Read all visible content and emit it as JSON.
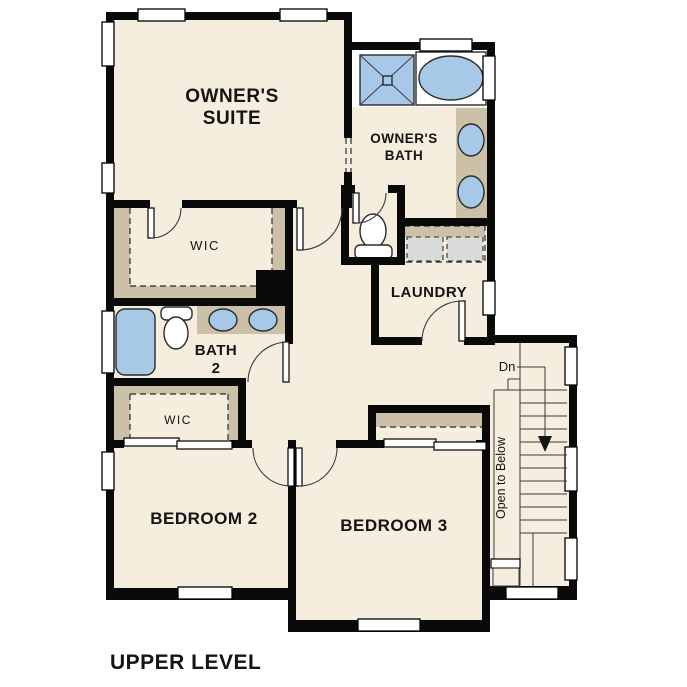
{
  "floor_label": "UPPER LEVEL",
  "rooms": {
    "owners_suite": {
      "line1": "OWNER'S",
      "line2": "SUITE"
    },
    "owners_bath": {
      "line1": "OWNER'S",
      "line2": "BATH"
    },
    "owners_wic": {
      "label": "WIC"
    },
    "bath2": {
      "line1": "BATH",
      "line2": "2"
    },
    "laundry": {
      "label": "LAUNDRY"
    },
    "bedroom2_wic": {
      "label": "WIC"
    },
    "bedroom2": {
      "label": "BEDROOM 2"
    },
    "bedroom3": {
      "label": "BEDROOM 3"
    }
  },
  "stairs": {
    "direction_label": "Dn",
    "open_to_below_label": "Open to Below"
  },
  "fixtures": [
    "shower",
    "soaking-tub",
    "double-vanity",
    "toilet",
    "washer-dryer",
    "bathtub",
    "toilet",
    "double-vanity"
  ],
  "palette": {
    "wall": "#0a0a0a",
    "floor": "#f5eddd",
    "closet_tan": "#ccc0a8",
    "fixture_blue": "#a8c8e8",
    "appliance_gray": "#dadada",
    "background": "#ffffff"
  }
}
